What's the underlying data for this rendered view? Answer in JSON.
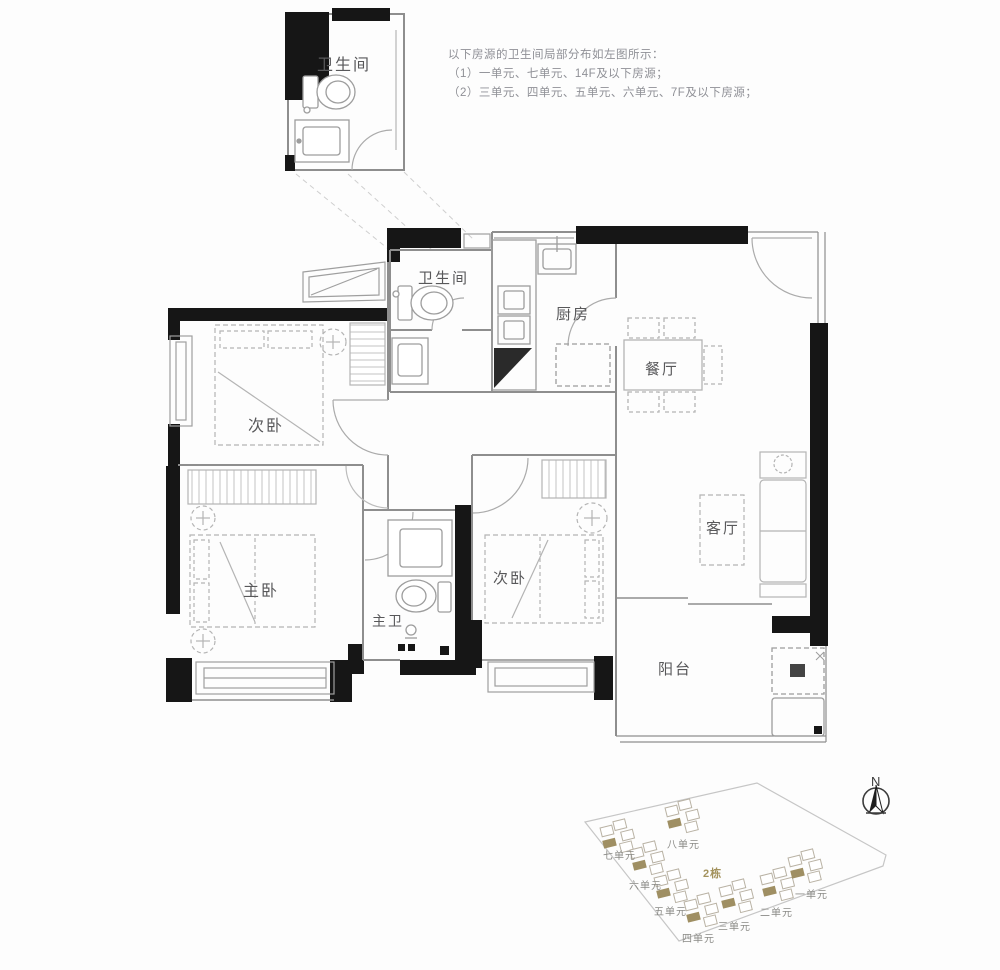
{
  "annotation": {
    "line1": "以下房源的卫生间局部分布如左图所示：",
    "line2": "（1）一单元、七单元、14F及以下房源；",
    "line3": "（2）三单元、四单元、五单元、六单元、7F及以下房源；"
  },
  "detail_inset": {
    "room_label": "卫生间"
  },
  "floorplan": {
    "rooms": [
      {
        "name": "bathroom",
        "label": "卫生间"
      },
      {
        "name": "kitchen",
        "label": "厨房"
      },
      {
        "name": "dining",
        "label": "餐厅"
      },
      {
        "name": "bedroom-top",
        "label": "次卧"
      },
      {
        "name": "master-bedroom",
        "label": "主卧"
      },
      {
        "name": "master-bathroom",
        "label": "主卫"
      },
      {
        "name": "bedroom-middle",
        "label": "次卧"
      },
      {
        "name": "living",
        "label": "客厅"
      },
      {
        "name": "balcony",
        "label": "阳台"
      }
    ]
  },
  "siteplan": {
    "building_label": "2栋",
    "north_label": "N",
    "units": [
      {
        "label": "一单元"
      },
      {
        "label": "二单元"
      },
      {
        "label": "三单元"
      },
      {
        "label": "四单元"
      },
      {
        "label": "五单元"
      },
      {
        "label": "六单元"
      },
      {
        "label": "七单元"
      },
      {
        "label": "八单元"
      }
    ]
  },
  "colors": {
    "wall_black": "#161616",
    "wall_gray": "#8e8e8e",
    "furniture": "#b4b4b4",
    "accent_olive": "#a3925d"
  }
}
